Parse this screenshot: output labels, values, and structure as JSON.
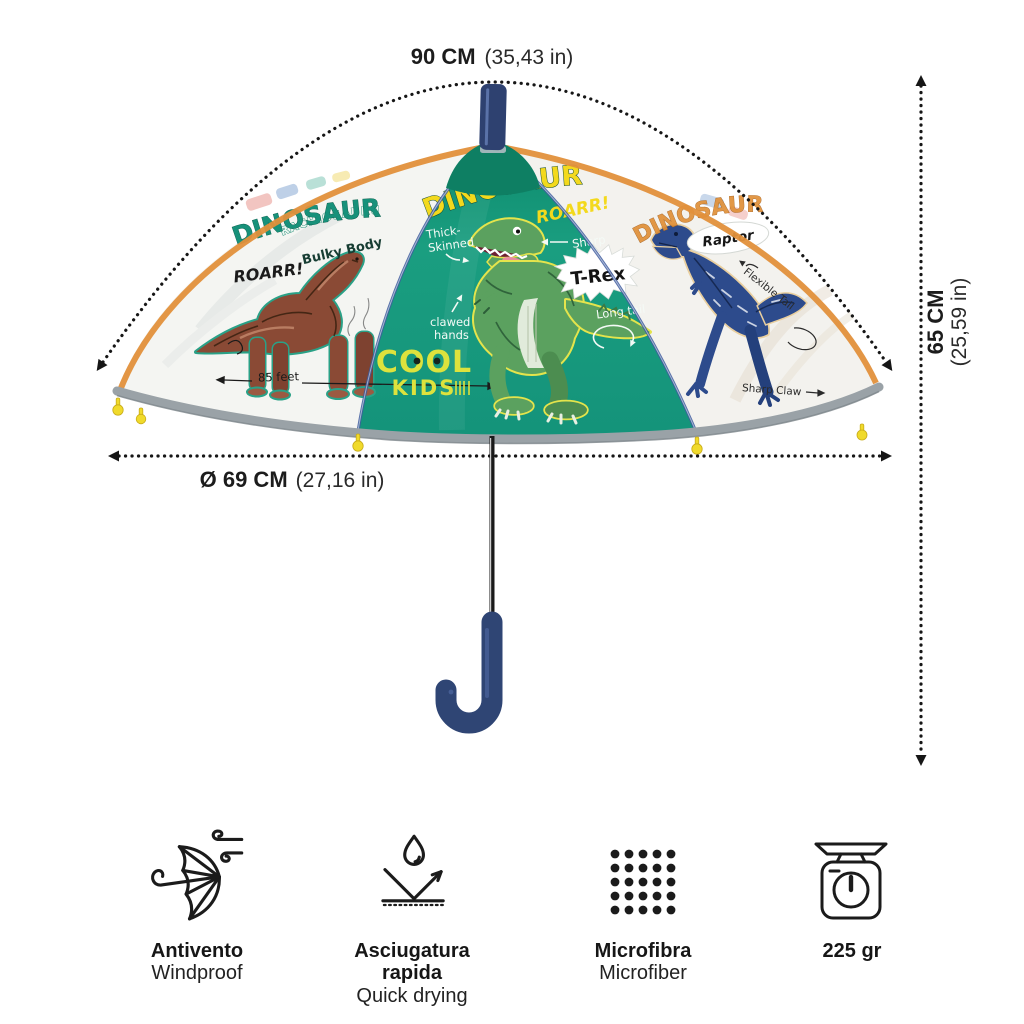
{
  "measurements": {
    "width": {
      "value": "90 CM",
      "inches": "(35,43 in)"
    },
    "height": {
      "value": "65 CM",
      "inches": "(25,59 in)"
    },
    "diameter": {
      "value": "Ø 69 CM",
      "inches": "(27,16 in)"
    }
  },
  "umbrella": {
    "center_panel": {
      "title": "DINOSAUR",
      "roar": "ROARR!",
      "label_thick_skinned_1": "Thick-",
      "label_thick_skinned_2": "Skinned",
      "label_sharp_teeth_1": "Sharp",
      "label_sharp_teeth_2": "teeth",
      "label_clawed_hands_1": "clawed",
      "label_clawed_hands_2": "hands",
      "label_long_tail": "Long tail",
      "species_badge": "T-Rex",
      "brand_top": "COOL",
      "brand_bottom": "KIDS"
    },
    "left_panel": {
      "species": "BRACHIOSAURUS",
      "title": "DINOSAUR",
      "label_bulky_body": "Bulky Body",
      "roar": "ROARR!",
      "label_long_tail": "Long Tail",
      "label_length": "85 feet"
    },
    "right_panel": {
      "title": "DINOSAUR",
      "species_badge": "Raptor",
      "label_flexible_tail": "Flexible Tail",
      "label_sharp_claw": "Sharp Claw"
    }
  },
  "features": [
    {
      "label_primary": "Antivento",
      "label_secondary": "Windproof",
      "icon": "windproof-umbrella-icon"
    },
    {
      "label_primary": "Asciugatura rapida",
      "label_secondary": "Quick drying",
      "icon": "quick-dry-icon"
    },
    {
      "label_primary": "Microfibra",
      "label_secondary": "Microfiber",
      "icon": "microfiber-dots-icon"
    },
    {
      "label_primary": "225 gr",
      "label_secondary": "",
      "icon": "weight-scale-icon"
    }
  ],
  "colors": {
    "canopy_teal": "#17997b",
    "accent_yellow": "#f2d91f",
    "brand_yellow": "#dde23d",
    "handle_navy": "#2f4574",
    "trim_orange": "#e2903b",
    "trim_gray": "#9aa2a7",
    "tip_yellow": "#f0da2b",
    "dino_brown": "#8a4a35",
    "dino_green": "#5ba15f",
    "dino_blue": "#2d4b8c",
    "text_dark": "#1c1c1c"
  }
}
